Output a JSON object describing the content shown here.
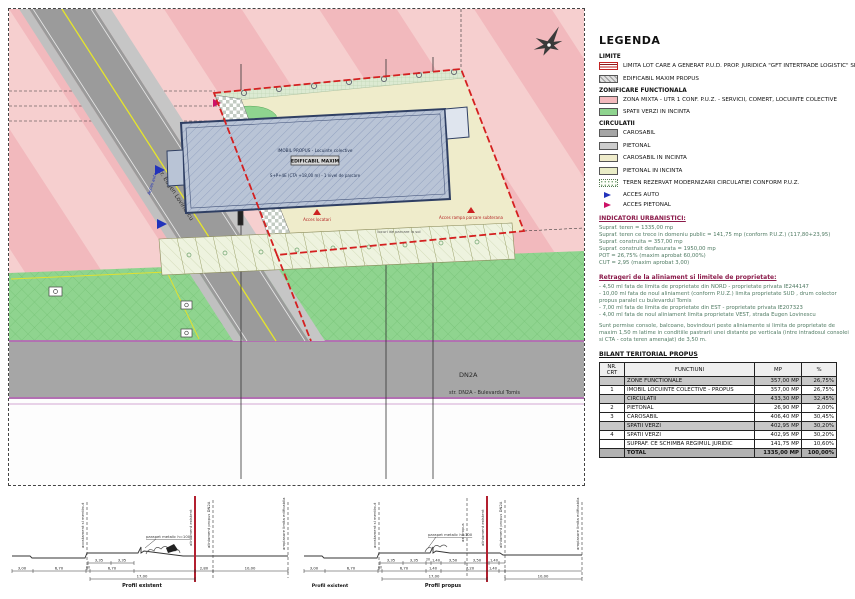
{
  "colors": {
    "zona_mixta_pink": "#f2b9bd",
    "zona_mixta_pink_light": "#f6cfcf",
    "spatii_verzi_green": "#8fd48f",
    "carosabil_gray": "#a5a5a5",
    "pietonal_gray": "#cdcdcd",
    "carosabil_incinta_beige": "#efeccb",
    "pietonal_incinta": "#e9edc6",
    "limita_red": "#d42020",
    "building_fill": "#b9c4d6",
    "building_border": "#2f3f63",
    "acces_auto_blue": "#2233bb",
    "acces_pietonal_magenta": "#cc1166",
    "road_edge_purple": "#b468b4"
  },
  "plan": {
    "street_label": "str. Eugen Lovinescu",
    "road_label": "DN2A",
    "road_sublabel": "str. DN2A - Bulevardul Tomis",
    "building": {
      "line1": "IMOBIL PROPUS - Locuinte colective",
      "line2": "EDIFICABIL MAXIM",
      "line3": "S+P+4E (CTA +18,00 m) - 1 nivel de parcare"
    },
    "acces_locatari": "Acces locatari",
    "acces_rampa": "Acces rampa parcare subterana",
    "parcare_note": "locuri de parcare la sol",
    "acces_auto": "Acces auto"
  },
  "legend": {
    "title": "LEGENDA",
    "headings": {
      "limite": "LIMITE",
      "zonificare": "ZONIFICARE FUNCTIONALA",
      "circulatii": "CIRCULATII"
    },
    "items": [
      {
        "label": "LIMITA LOT CARE A GENERAT P.U.D. PROP. JURIDICA \"GFT INTERTRADE LOGISTIC\" SRL"
      },
      {
        "label": "EDIFICABIL MAXIM PROPUS"
      },
      {
        "label": "ZONA MIXTA - UTR 1 CONF. P.U.Z. - SERVICII, COMERT, LOCUINTE COLECTIVE"
      },
      {
        "label": "SPATII VERZI IN INCINTA"
      },
      {
        "label": "CAROSABIL"
      },
      {
        "label": "PIETONAL"
      },
      {
        "label": "CAROSABIL IN INCINTA"
      },
      {
        "label": "PIETONAL IN INCINTA"
      },
      {
        "label": "TEREN REZERVAT MODERNIZARII CIRCULATIEI CONFORM P.U.Z."
      },
      {
        "label": "ACCES AUTO"
      },
      {
        "label": "ACCES PIETONAL"
      }
    ]
  },
  "indicators": {
    "title": "INDICATORI URBANISTICI:",
    "lines": [
      "Supraf. teren = 1335,00 mp",
      "Supraf. teren ce trece in domeniu public = 141,75 mp (conform P.U.Z.) (117,80+23,95)",
      "Supraf. construita = 357,00 mp",
      "Supraf. construit desfasurata = 1950,00 mp",
      "POT = 26,75% (maxim aprobat 60,00%)",
      "CUT = 2,95 (maxim aprobat 3,00)"
    ],
    "retrageri_title": "Retrageri de la aliniament si limitele de proprietate:",
    "retrageri_lines": [
      "- 4,50 ml fata de limita de proprietate din NORD - proprietate privata IE244147",
      "- 10,00 ml fata de noul aliniament (conform P.U.Z.) limita proprietate SUD , drum colector propus paralel cu bulevardul Tomis",
      "- 7,00 ml fata de limita de proprietate din EST - proprietate privata IE207323",
      "- 4,00 ml fata de noul aliniament limita proprietate VEST, strada Eugen Lovinescu"
    ],
    "note": "Sunt permise console, balcoane, bovindouri peste aliniamente si limita de proprietate de maxim 1,50 m latime in conditiile pastrarii unei distante pe verticala (intre intradosul consolei si CTA - cota teren amenajat) de 3,50 m."
  },
  "bilant": {
    "title": "BILANT TERITORIAL PROPUS",
    "columns": [
      "NR. CRT",
      "FUNCTIUNI",
      "MP",
      "%"
    ],
    "rows": [
      {
        "nr": "",
        "functiune": "ZONE FUNCTIONALE",
        "mp": "357,00 MP",
        "pct": "26,75%"
      },
      {
        "nr": "1",
        "functiune": "IMOBIL LOCUINTE COLECTIVE - PROPUS",
        "mp": "357,00 MP",
        "pct": "26,75%"
      },
      {
        "nr": "",
        "functiune": "CIRCULATII",
        "mp": "433,30 MP",
        "pct": "32,45%"
      },
      {
        "nr": "2",
        "functiune": "PIETONAL",
        "mp": "26,90 MP",
        "pct": "2,00%"
      },
      {
        "nr": "3",
        "functiune": "CAROSABIL",
        "mp": "406,40 MP",
        "pct": "30,45%"
      },
      {
        "nr": "",
        "functiune": "SPATII VERZI",
        "mp": "402,95 MP",
        "pct": "30,20%"
      },
      {
        "nr": "4",
        "functiune": "SPATII VERZI",
        "mp": "402,95 MP",
        "pct": "30,20%"
      },
      {
        "nr": "",
        "functiune": "SUPRAF. CE SCHIMBA REGIMUL JURIDIC",
        "mp": "141,75 MP",
        "pct": "10,60%"
      },
      {
        "nr": "",
        "functiune": "TOTAL",
        "mp": "1335,00 MP",
        "pct": "100,00%"
      }
    ]
  },
  "profiles": {
    "left": {
      "name": "Profil existent",
      "row1": [
        "3,35",
        "3,35"
      ],
      "row2": [
        "3,00",
        "6,70",
        "80",
        "6,70",
        "2,80",
        "10,00"
      ],
      "row3": [
        "17,00"
      ]
    },
    "right": {
      "name_left": "Profil existent",
      "name": "Profil propus",
      "row1": [
        "3,35",
        "3,35",
        "20",
        "1,40",
        "3,50",
        "3,50",
        "1,40"
      ],
      "row2": [
        "3,00",
        "6,70",
        "80",
        "6,70",
        "1,40",
        "7,20",
        "1,40"
      ],
      "row3": [
        "17,00",
        "10,00"
      ]
    },
    "labels": {
      "parapet": "parapet metalic h=100",
      "acostament": "acostament si mentinut",
      "alin_exist": "aliniament existent",
      "alin_prop": "aliniament propus DN2A",
      "ax": "ax propus",
      "limita": "amplasare limita edificabila"
    }
  }
}
